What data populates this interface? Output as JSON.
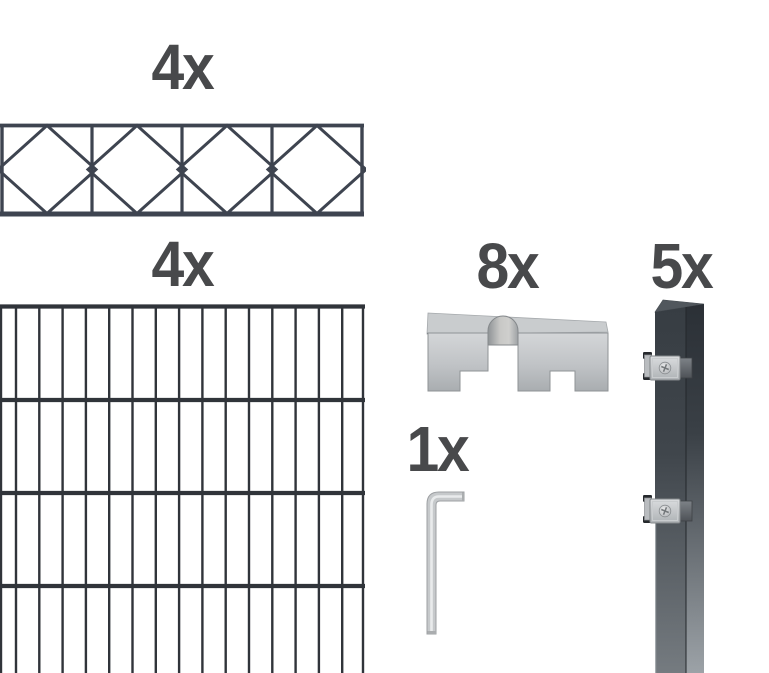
{
  "product_kit": {
    "decor_panel": {
      "qty_label": "4x"
    },
    "mesh_panel": {
      "qty_label": "4x"
    },
    "clamp": {
      "qty_label": "8x"
    },
    "hex_key": {
      "qty_label": "1x"
    },
    "post": {
      "qty_label": "5x"
    }
  },
  "colors": {
    "background": "#ffffff",
    "label_text": "#48494b",
    "decor_panel_wire": "#3e4450",
    "mesh_panel_wire": "#30343a",
    "metal_silver_light": "#d6d8da",
    "metal_silver_mid": "#bfc2c5",
    "metal_silver_dark": "#9a9ea1",
    "post_anthracite_top": "#31373d",
    "post_anthracite_bottom": "#9aa0a5"
  }
}
